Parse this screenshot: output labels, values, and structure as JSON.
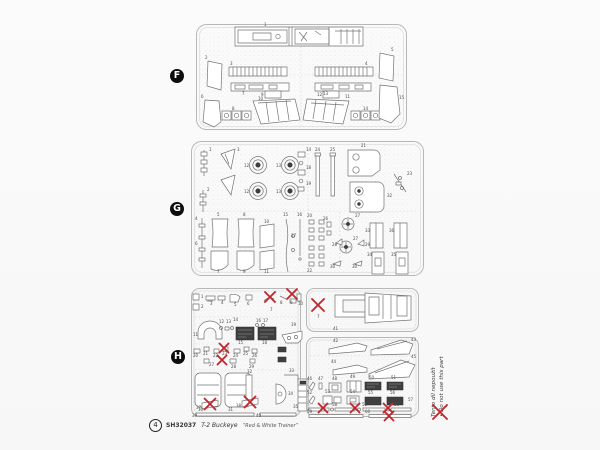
{
  "page": {
    "background": "#fdfdfd",
    "accent_red": "#c1272d",
    "line_gray": "#737373"
  },
  "sprues": [
    {
      "letter": "F"
    },
    {
      "letter": "G"
    },
    {
      "letter": "H"
    }
  ],
  "note": {
    "czech": "Tento díl nepoužít",
    "english": "Do not use this part"
  },
  "footer": {
    "page_number": "4",
    "kit_code": "SH32037",
    "kit_name": "T-2 Buckeye",
    "kit_variant": "“Red & White Trainer”"
  },
  "part_labels": {
    "F": [
      {
        "t": "1",
        "x": 69,
        "y": 3
      },
      {
        "t": "2",
        "x": 10,
        "y": 36
      },
      {
        "t": "3",
        "x": 35,
        "y": 42
      },
      {
        "t": "4",
        "x": 170,
        "y": 42
      },
      {
        "t": "5",
        "x": 196,
        "y": 28
      },
      {
        "t": "6",
        "x": 6,
        "y": 75
      },
      {
        "t": "7",
        "x": 47,
        "y": 72
      },
      {
        "t": "8",
        "x": 37,
        "y": 87
      },
      {
        "t": "9",
        "x": 66,
        "y": 73
      },
      {
        "t": "10",
        "x": 63,
        "y": 77
      },
      {
        "t": "11",
        "x": 150,
        "y": 75
      },
      {
        "t": "12",
        "x": 122,
        "y": 73
      },
      {
        "t": "13",
        "x": 128,
        "y": 72
      },
      {
        "t": "14",
        "x": 168,
        "y": 87
      },
      {
        "t": "15",
        "x": 204,
        "y": 76
      }
    ],
    "G": [
      {
        "t": "1",
        "x": 19,
        "y": 11
      },
      {
        "t": "3",
        "x": 47,
        "y": 11
      },
      {
        "t": "2",
        "x": 17,
        "y": 51
      },
      {
        "t": "12",
        "x": 54,
        "y": 27
      },
      {
        "t": "13",
        "x": 86,
        "y": 27
      },
      {
        "t": "12",
        "x": 54,
        "y": 53
      },
      {
        "t": "13",
        "x": 86,
        "y": 53
      },
      {
        "t": "14",
        "x": 116,
        "y": 11
      },
      {
        "t": "18",
        "x": 116,
        "y": 29
      },
      {
        "t": "19",
        "x": 116,
        "y": 45
      },
      {
        "t": "24",
        "x": 125,
        "y": 11
      },
      {
        "t": "25",
        "x": 140,
        "y": 11
      },
      {
        "t": "21",
        "x": 171,
        "y": 7
      },
      {
        "t": "32",
        "x": 197,
        "y": 57
      },
      {
        "t": "23",
        "x": 217,
        "y": 35
      },
      {
        "t": "4",
        "x": 5,
        "y": 80
      },
      {
        "t": "5",
        "x": 27,
        "y": 76
      },
      {
        "t": "8",
        "x": 53,
        "y": 76
      },
      {
        "t": "6",
        "x": 5,
        "y": 105
      },
      {
        "t": "10",
        "x": 74,
        "y": 83
      },
      {
        "t": "7",
        "x": 27,
        "y": 133
      },
      {
        "t": "9",
        "x": 53,
        "y": 133
      },
      {
        "t": "11",
        "x": 74,
        "y": 133
      },
      {
        "t": "15",
        "x": 93,
        "y": 76
      },
      {
        "t": "16",
        "x": 107,
        "y": 76
      },
      {
        "t": "17",
        "x": 101,
        "y": 97
      },
      {
        "t": "20",
        "x": 117,
        "y": 77
      },
      {
        "t": "22",
        "x": 117,
        "y": 132
      },
      {
        "t": "26",
        "x": 133,
        "y": 80
      },
      {
        "t": "27",
        "x": 165,
        "y": 77
      },
      {
        "t": "27",
        "x": 163,
        "y": 100
      },
      {
        "t": "28",
        "x": 142,
        "y": 106
      },
      {
        "t": "29",
        "x": 175,
        "y": 106
      },
      {
        "t": "30",
        "x": 140,
        "y": 128
      },
      {
        "t": "30",
        "x": 162,
        "y": 128
      },
      {
        "t": "33",
        "x": 175,
        "y": 92
      },
      {
        "t": "36",
        "x": 199,
        "y": 92
      },
      {
        "t": "34",
        "x": 177,
        "y": 116
      },
      {
        "t": "35",
        "x": 201,
        "y": 116
      }
    ],
    "H_left": [
      {
        "t": "1",
        "x": 11,
        "y": 11
      },
      {
        "t": "2",
        "x": 11,
        "y": 21
      },
      {
        "t": "3",
        "x": 20,
        "y": 18
      },
      {
        "t": "4",
        "x": 31,
        "y": 17
      },
      {
        "t": "5",
        "x": 44,
        "y": 19
      },
      {
        "t": "6",
        "x": 57,
        "y": 18
      },
      {
        "t": "7",
        "x": 80,
        "y": 24
      },
      {
        "t": "8",
        "x": 90,
        "y": 17
      },
      {
        "t": "9",
        "x": 100,
        "y": 17
      },
      {
        "t": "10",
        "x": 108,
        "y": 18
      },
      {
        "t": "11",
        "x": 3,
        "y": 49
      },
      {
        "t": "12",
        "x": 29,
        "y": 36
      },
      {
        "t": "13",
        "x": 36,
        "y": 36
      },
      {
        "t": "14",
        "x": 43,
        "y": 34
      },
      {
        "t": "15",
        "x": 48,
        "y": 57
      },
      {
        "t": "16",
        "x": 66,
        "y": 35
      },
      {
        "t": "17",
        "x": 73,
        "y": 35
      },
      {
        "t": "18",
        "x": 72,
        "y": 57
      },
      {
        "t": "19",
        "x": 101,
        "y": 39
      },
      {
        "t": "20",
        "x": 3,
        "y": 70
      },
      {
        "t": "21",
        "x": 13,
        "y": 68
      },
      {
        "t": "22",
        "x": 23,
        "y": 70
      },
      {
        "t": "23",
        "x": 32,
        "y": 68
      },
      {
        "t": "24",
        "x": 43,
        "y": 70
      },
      {
        "t": "25",
        "x": 53,
        "y": 68
      },
      {
        "t": "26",
        "x": 62,
        "y": 70
      },
      {
        "t": "27",
        "x": 19,
        "y": 79
      },
      {
        "t": "28",
        "x": 41,
        "y": 81
      },
      {
        "t": "29",
        "x": 59,
        "y": 81
      },
      {
        "t": "30",
        "x": 8,
        "y": 124
      },
      {
        "t": "31",
        "x": 38,
        "y": 124
      },
      {
        "t": "32",
        "x": 57,
        "y": 86
      },
      {
        "t": "33",
        "x": 99,
        "y": 85
      },
      {
        "t": "34",
        "x": 98,
        "y": 108
      },
      {
        "t": "35",
        "x": 103,
        "y": 121
      },
      {
        "t": "37",
        "x": 6,
        "y": 122
      },
      {
        "t": "38",
        "x": 46,
        "y": 120
      },
      {
        "t": "39",
        "x": 2,
        "y": 130
      },
      {
        "t": "40",
        "x": 66,
        "y": 130
      }
    ],
    "H_a": [
      {
        "t": "7",
        "x": 12,
        "y": 31
      },
      {
        "t": "41",
        "x": 28,
        "y": 43
      }
    ],
    "H_b": [
      {
        "t": "42",
        "x": 28,
        "y": 6
      },
      {
        "t": "43",
        "x": 106,
        "y": 5
      },
      {
        "t": "44",
        "x": 26,
        "y": 27
      },
      {
        "t": "45",
        "x": 106,
        "y": 22
      },
      {
        "t": "46",
        "x": 2,
        "y": 44
      },
      {
        "t": "47",
        "x": 13,
        "y": 44
      },
      {
        "t": "48",
        "x": 27,
        "y": 44
      },
      {
        "t": "49",
        "x": 45,
        "y": 42
      },
      {
        "t": "50",
        "x": 64,
        "y": 43
      },
      {
        "t": "51",
        "x": 86,
        "y": 43
      },
      {
        "t": "52",
        "x": 2,
        "y": 58
      },
      {
        "t": "53",
        "x": 20,
        "y": 57
      },
      {
        "t": "54",
        "x": 45,
        "y": 57
      },
      {
        "t": "55",
        "x": 63,
        "y": 58
      },
      {
        "t": "56",
        "x": 85,
        "y": 58
      },
      {
        "t": "57",
        "x": 103,
        "y": 65
      },
      {
        "t": "58",
        "x": 27,
        "y": 70
      },
      {
        "t": "58",
        "x": 57,
        "y": 70
      },
      {
        "t": "58",
        "x": 89,
        "y": 70
      },
      {
        "t": "59",
        "x": 2,
        "y": 77
      },
      {
        "t": "60",
        "x": 60,
        "y": 77
      }
    ],
    "legend": []
  },
  "xmarks": {
    "F": [],
    "G": [],
    "H_left": [
      {
        "x": 80,
        "y": 10,
        "s": 10
      },
      {
        "x": 102,
        "y": 7,
        "s": 10
      },
      {
        "x": 34,
        "y": 61,
        "s": 9
      },
      {
        "x": 32,
        "y": 73,
        "s": 9
      },
      {
        "x": 20,
        "y": 117,
        "s": 11
      },
      {
        "x": 60,
        "y": 115,
        "s": 11
      }
    ],
    "H_a": [
      {
        "x": 13,
        "y": 18,
        "s": 12
      }
    ],
    "H_b": [
      {
        "x": 18,
        "y": 72,
        "s": 9
      },
      {
        "x": 50,
        "y": 72,
        "s": 9
      },
      {
        "x": 83,
        "y": 72,
        "s": 9
      },
      {
        "x": 84,
        "y": 80,
        "s": 9
      }
    ],
    "legend": [
      {
        "x": 9,
        "y": 9,
        "s": 14
      }
    ]
  }
}
